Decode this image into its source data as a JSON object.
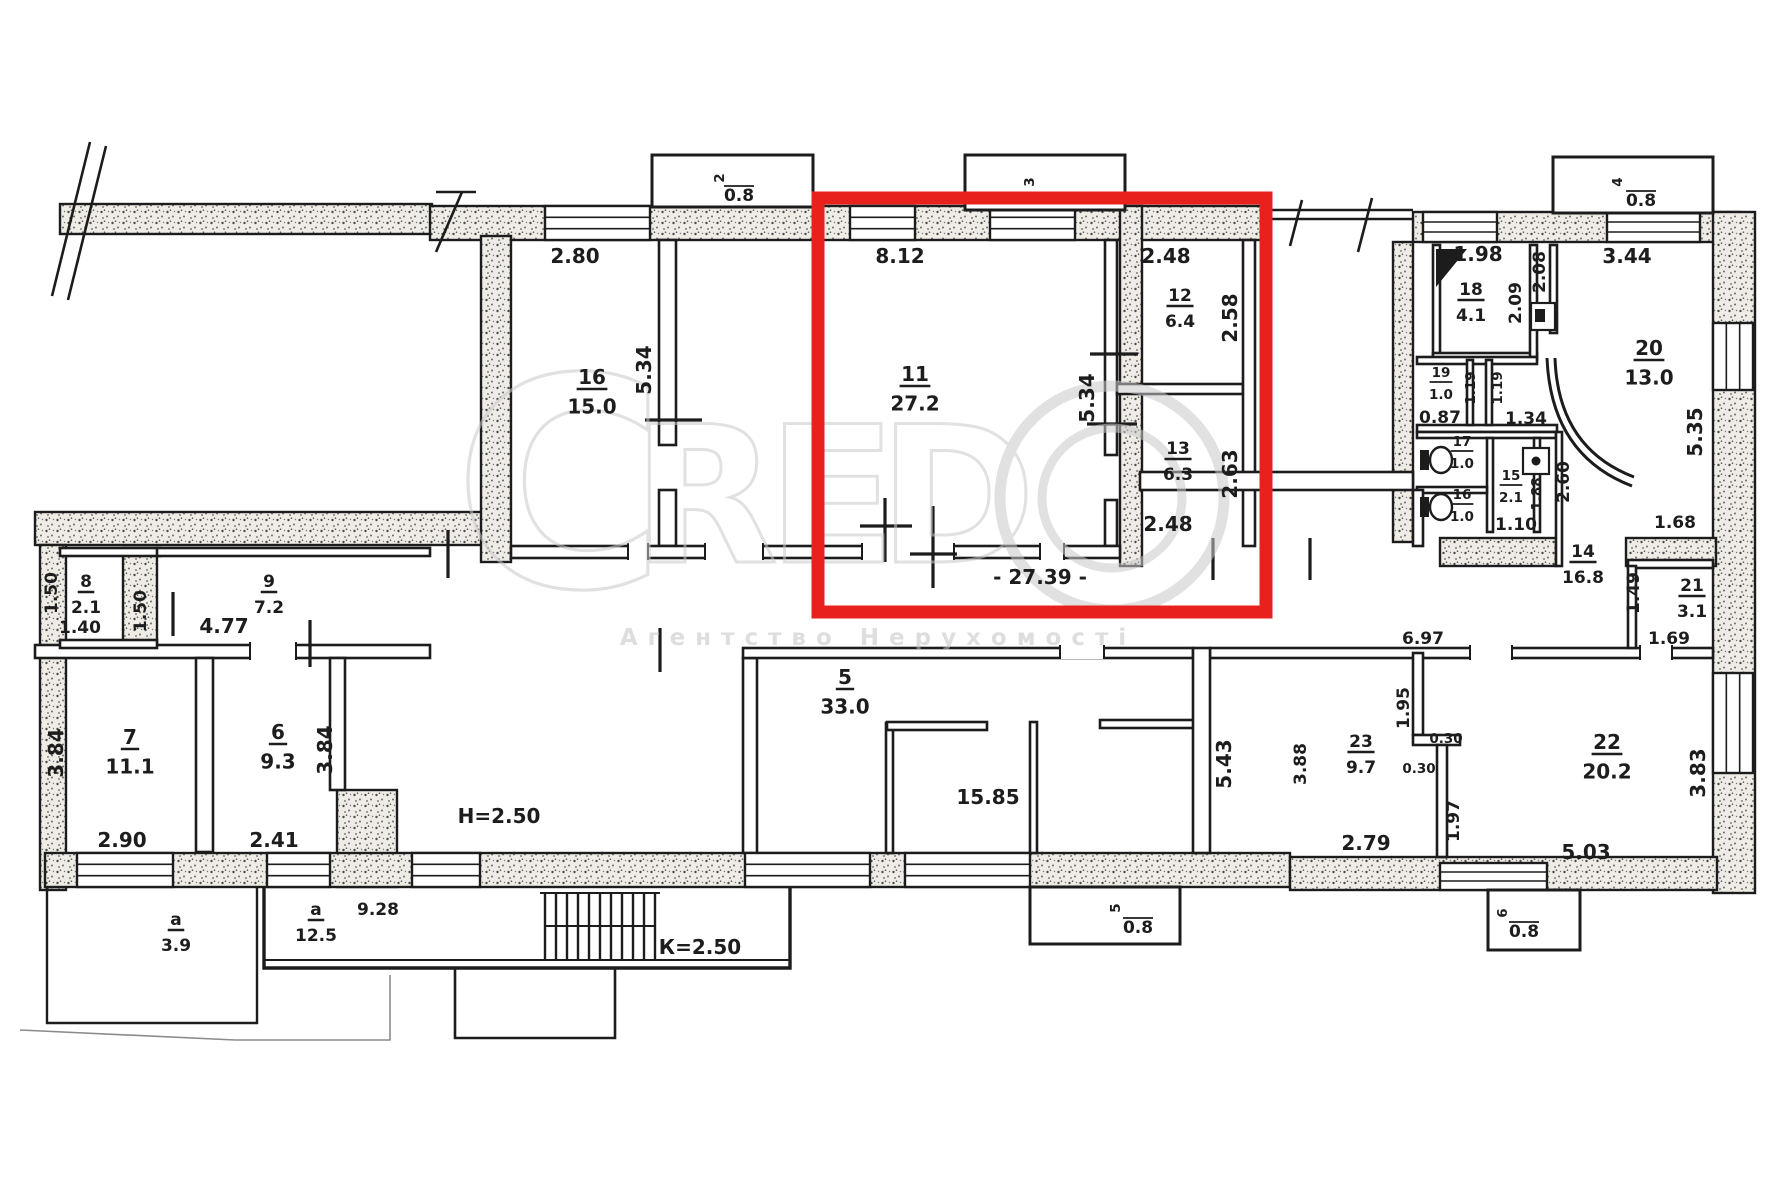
{
  "watermark": {
    "brand": "CREDO",
    "tagline": "Агентство Нерухомості"
  },
  "highlight": {
    "color": "#e8211c"
  },
  "rooms": [
    {
      "num": "16",
      "area": "15.0",
      "x": 592,
      "y": 384
    },
    {
      "num": "11",
      "area": "27.2",
      "x": 915,
      "y": 381
    },
    {
      "num": "12",
      "area": "6.4",
      "x": 1180,
      "y": 301,
      "s": 1
    },
    {
      "num": "13",
      "area": "6.3",
      "x": 1178,
      "y": 454,
      "s": 1
    },
    {
      "num": "18",
      "area": "4.1",
      "x": 1471,
      "y": 295,
      "s": 1
    },
    {
      "num": "19",
      "area": "1.0",
      "x": 1441,
      "y": 377,
      "s": 2
    },
    {
      "num": "17",
      "area": "1.0",
      "x": 1462,
      "y": 446,
      "s": 2
    },
    {
      "num": "15",
      "area": "2.1",
      "x": 1511,
      "y": 480,
      "s": 2
    },
    {
      "num": "16",
      "area": "1.0",
      "x": 1462,
      "y": 499,
      "s": 2
    },
    {
      "num": "20",
      "area": "13.0",
      "x": 1649,
      "y": 355
    },
    {
      "num": "14",
      "area": "16.8",
      "x": 1583,
      "y": 557,
      "s": 1
    },
    {
      "num": "21",
      "area": "3.1",
      "x": 1692,
      "y": 591,
      "s": 1
    },
    {
      "num": "8",
      "area": "2.1",
      "x": 86,
      "y": 587,
      "s": 1
    },
    {
      "num": "9",
      "area": "7.2",
      "x": 269,
      "y": 587,
      "s": 1
    },
    {
      "num": "7",
      "area": "11.1",
      "x": 130,
      "y": 744
    },
    {
      "num": "6",
      "area": "9.3",
      "x": 278,
      "y": 739
    },
    {
      "num": "5",
      "area": "33.0",
      "x": 845,
      "y": 684
    },
    {
      "num": "23",
      "area": "9.7",
      "x": 1361,
      "y": 747,
      "s": 1
    },
    {
      "num": "22",
      "area": "20.2",
      "x": 1607,
      "y": 749
    },
    {
      "num": "а",
      "area": "3.9",
      "x": 176,
      "y": 925,
      "s": 1
    },
    {
      "num": "а",
      "area": "12.5",
      "x": 316,
      "y": 915,
      "s": 1
    }
  ],
  "dims": [
    {
      "t": "2.80",
      "x": 575,
      "y": 263
    },
    {
      "t": "8.12",
      "x": 900,
      "y": 263
    },
    {
      "t": "2.48",
      "x": 1166,
      "y": 263
    },
    {
      "t": "1.98",
      "x": 1478,
      "y": 261
    },
    {
      "t": "3.44",
      "x": 1627,
      "y": 263
    },
    {
      "t": "5.34",
      "x": 651,
      "y": 370,
      "r": 1
    },
    {
      "t": "5.34",
      "x": 1094,
      "y": 398,
      "r": 1
    },
    {
      "t": "2.58",
      "x": 1237,
      "y": 318,
      "r": 1
    },
    {
      "t": "2.63",
      "x": 1237,
      "y": 474,
      "r": 1
    },
    {
      "t": "2.48",
      "x": 1168,
      "y": 531
    },
    {
      "t": "2.09",
      "x": 1521,
      "y": 303,
      "r": 1,
      "s": 1
    },
    {
      "t": "2.08",
      "x": 1545,
      "y": 272,
      "r": 1,
      "s": 1
    },
    {
      "t": "5.35",
      "x": 1702,
      "y": 432,
      "r": 1
    },
    {
      "t": "1.19",
      "x": 1475,
      "y": 388,
      "r": 1,
      "s": 2
    },
    {
      "t": "1.19",
      "x": 1502,
      "y": 388,
      "r": 1,
      "s": 2
    },
    {
      "t": "0.87",
      "x": 1440,
      "y": 423,
      "s": 1
    },
    {
      "t": "1.34",
      "x": 1526,
      "y": 424,
      "s": 1
    },
    {
      "t": "1.10",
      "x": 1516,
      "y": 530,
      "s": 1
    },
    {
      "t": "1.88",
      "x": 1541,
      "y": 494,
      "r": 1,
      "s": 2
    },
    {
      "t": "2.60",
      "x": 1569,
      "y": 482,
      "r": 1,
      "s": 1
    },
    {
      "t": "1.68",
      "x": 1675,
      "y": 528,
      "s": 1
    },
    {
      "t": "1.49",
      "x": 1639,
      "y": 593,
      "r": 1,
      "s": 1
    },
    {
      "t": "1.69",
      "x": 1669,
      "y": 644,
      "s": 1
    },
    {
      "t": "6.97",
      "x": 1423,
      "y": 644,
      "s": 1
    },
    {
      "t": "- 27.39 -",
      "x": 1040,
      "y": 584
    },
    {
      "t": "1.50",
      "x": 57,
      "y": 593,
      "r": 1,
      "s": 1
    },
    {
      "t": "1.40",
      "x": 80,
      "y": 633,
      "s": 1
    },
    {
      "t": "1.50",
      "x": 146,
      "y": 611,
      "r": 1,
      "s": 1
    },
    {
      "t": "4.77",
      "x": 224,
      "y": 633
    },
    {
      "t": "3.84",
      "x": 63,
      "y": 753,
      "r": 1
    },
    {
      "t": "3.84",
      "x": 332,
      "y": 750,
      "r": 1
    },
    {
      "t": "2.90",
      "x": 122,
      "y": 847
    },
    {
      "t": "2.41",
      "x": 274,
      "y": 847
    },
    {
      "t": "9.28",
      "x": 378,
      "y": 915,
      "s": 1
    },
    {
      "t": "Н=2.50",
      "x": 499,
      "y": 823
    },
    {
      "t": "К=2.50",
      "x": 700,
      "y": 954
    },
    {
      "t": "15.85",
      "x": 988,
      "y": 804
    },
    {
      "t": "5.43",
      "x": 1231,
      "y": 764,
      "r": 1
    },
    {
      "t": "3.88",
      "x": 1306,
      "y": 764,
      "r": 1,
      "s": 1
    },
    {
      "t": "1.95",
      "x": 1409,
      "y": 708,
      "r": 1,
      "s": 1
    },
    {
      "t": "0.30",
      "x": 1446,
      "y": 743,
      "s": 2
    },
    {
      "t": "0.30",
      "x": 1419,
      "y": 773,
      "s": 2
    },
    {
      "t": "2.79",
      "x": 1366,
      "y": 850
    },
    {
      "t": "1.97",
      "x": 1459,
      "y": 821,
      "r": 1,
      "s": 1
    },
    {
      "t": "5.03",
      "x": 1586,
      "y": 859
    },
    {
      "t": "3.83",
      "x": 1705,
      "y": 773,
      "r": 1
    },
    {
      "t": "2",
      "x": 724,
      "y": 178,
      "r": 1,
      "s": 2
    },
    {
      "t": "0.8",
      "x": 739,
      "y": 201,
      "s": 1,
      "bar": 1
    },
    {
      "t": "3",
      "x": 1034,
      "y": 182,
      "r": 1,
      "s": 2
    },
    {
      "t": "4",
      "x": 1622,
      "y": 182,
      "r": 1,
      "s": 2
    },
    {
      "t": "0.8",
      "x": 1641,
      "y": 206,
      "s": 1,
      "bar": 1
    },
    {
      "t": "5",
      "x": 1120,
      "y": 908,
      "r": 1,
      "s": 2
    },
    {
      "t": "0.8",
      "x": 1138,
      "y": 933,
      "s": 1,
      "bar": 1
    },
    {
      "t": "6",
      "x": 1507,
      "y": 913,
      "r": 1,
      "s": 2
    },
    {
      "t": "0.8",
      "x": 1524,
      "y": 937,
      "s": 1,
      "bar": 1
    }
  ]
}
